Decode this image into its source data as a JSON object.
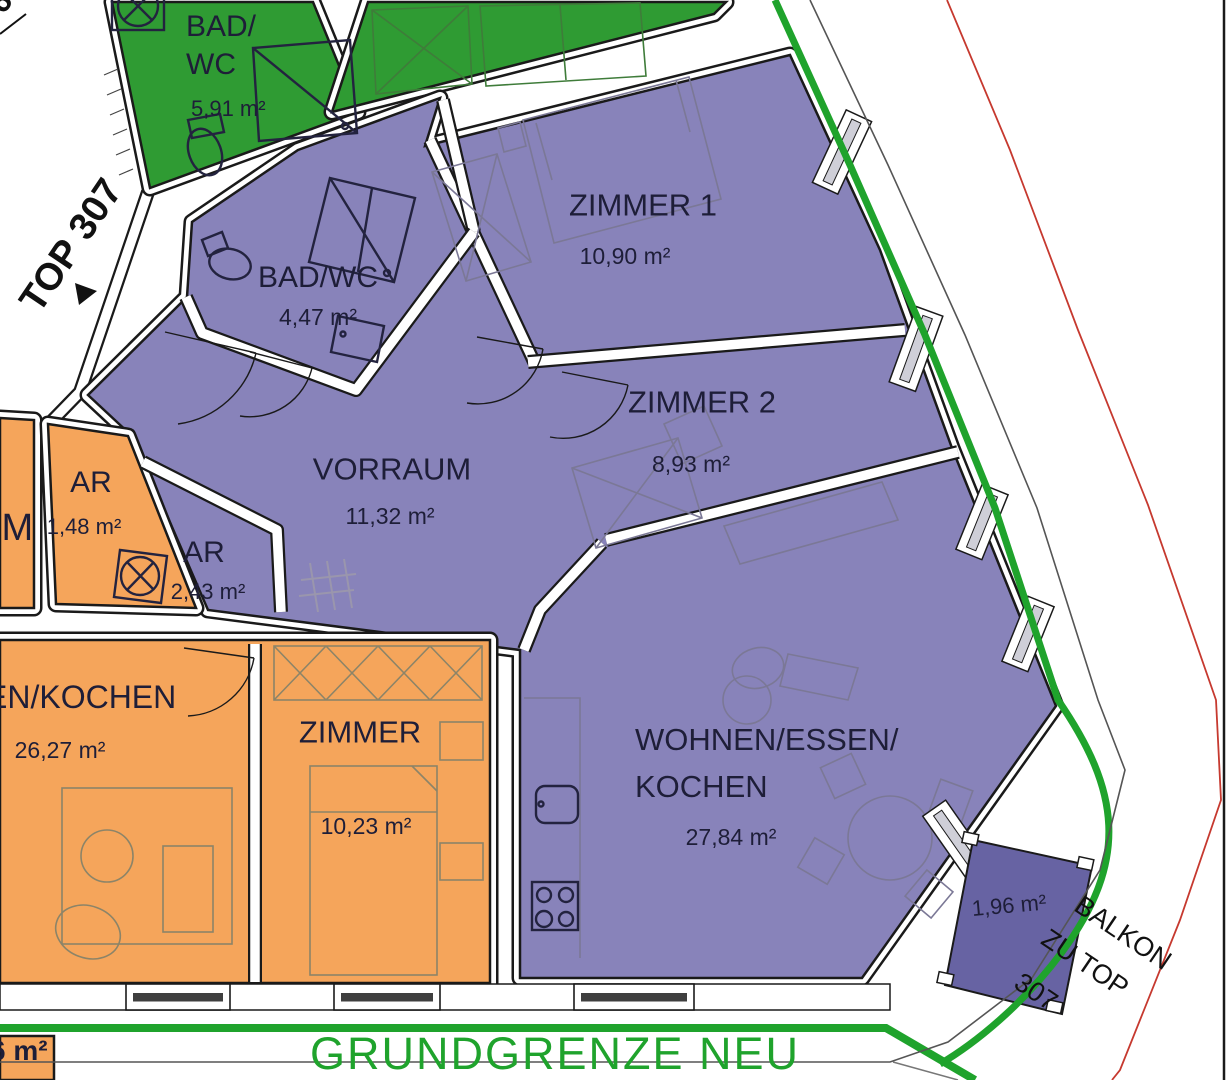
{
  "colors": {
    "purple": "#8883ba",
    "balcony": "#6763a3",
    "orange": "#f5a55b",
    "green": "#2f9b33",
    "line-green": "#1fa32c",
    "line-red": "#c6392f",
    "wall": "#1a1a1a"
  },
  "rooms": {
    "green_bad": {
      "name": "BAD/\nWC",
      "area": "5,91 m²"
    },
    "bad": {
      "name": "BAD/WC",
      "area": "4,47 m²"
    },
    "zimmer1": {
      "name": "ZIMMER 1",
      "area": "10,90 m²"
    },
    "zimmer2": {
      "name": "ZIMMER 2",
      "area": "8,93 m²"
    },
    "vorraum": {
      "name": "VORRAUM",
      "area": "11,32 m²"
    },
    "ar_orange": {
      "name": "AR",
      "area": "1,48 m²"
    },
    "ar_purple": {
      "name": "AR",
      "area": "2,43 m²"
    },
    "wohnen_orange": {
      "name": "EN/KOCHEN",
      "area": "26,27 m²"
    },
    "zimmer_orange": {
      "name": "ZIMMER",
      "area": "10,23 m²"
    },
    "wohnen": {
      "name": "WOHNEN/ESSEN/\nKOCHEN",
      "area": "27,84 m²"
    }
  },
  "labels": {
    "top_unit": "TOP 307",
    "balkon_line1": "BALKON",
    "balkon_line2": "ZU TOP",
    "balkon_line3": "307",
    "balkon_area": "1,96 m²",
    "grundgrenze": "GRUNDGRENZE NEU",
    "partial_left_mid": "UM",
    "partial_bottom_left": "6 m²",
    "partial_top_corner": "6"
  }
}
